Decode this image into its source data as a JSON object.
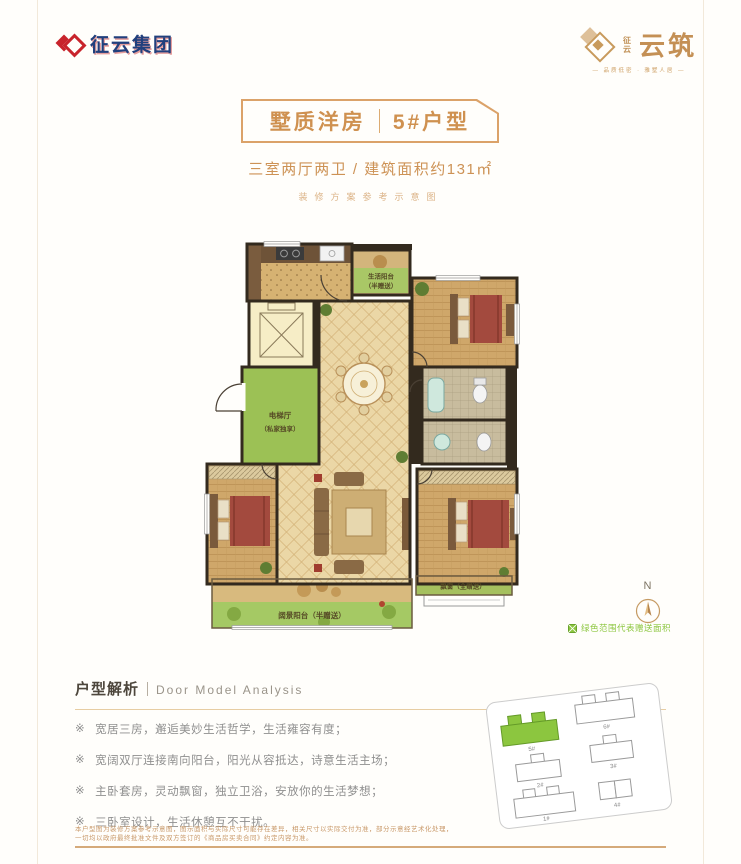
{
  "brand": {
    "group_name": "征云集团",
    "project_pre_top": "征",
    "project_pre_bottom": "云",
    "project_name": "云筑",
    "project_tagline": "— 品质低密 · 雅墅人居 —"
  },
  "title": {
    "left": "墅质洋房",
    "right": "5#户型",
    "subtitle": "三室两厅两卫 / 建筑面积约131㎡",
    "note": "装修方案参考示意图"
  },
  "floorplan": {
    "service_balcony_line1": "生活阳台",
    "service_balcony_line2": "（半赠送）",
    "elevator_hall_line1": "电梯厅",
    "elevator_hall_line2": "（私家独享）",
    "view_balcony_label": "阔景阳台（半赠送）",
    "bay_window_label": "飘窗（全赠送）",
    "compass_n": "N",
    "legend_note": "绿色范围代表赠送面积"
  },
  "analysis": {
    "heading_cn": "户型解析",
    "heading_en": "Door Model Analysis",
    "marker": "※",
    "points": [
      "宽居三房，邂逅美妙生活哲学，生活雍容有度；",
      "宽阔双厅连接南向阳台，阳光从容抵达，诗意生活主场；",
      "主卧套房，灵动飘窗，独立卫浴，安放你的生活梦想；",
      "三卧室设计，生活休憩互不干扰。"
    ]
  },
  "siteplan": {
    "buildings": [
      {
        "label": "5#",
        "highlighted": true
      },
      {
        "label": "6#",
        "highlighted": false
      },
      {
        "label": "2#",
        "highlighted": false
      },
      {
        "label": "3#",
        "highlighted": false
      },
      {
        "label": "1#",
        "highlighted": false
      },
      {
        "label": "4#",
        "highlighted": false
      }
    ]
  },
  "disclaimer": {
    "line1": "本户型图为装修方案参考示意图，图示面积与实际尺寸可能存在差异，相关尺寸以实际交付为准，部分示意经艺术化处理，",
    "line2": "一切均以政府最终批准文件及双方签订的《商品房买卖合同》约定内容为准。"
  },
  "colors": {
    "accent_gold": "#cd9255",
    "brand_red": "#c8242c",
    "brand_blue": "#21407d",
    "gift_green": "#9cc155"
  }
}
